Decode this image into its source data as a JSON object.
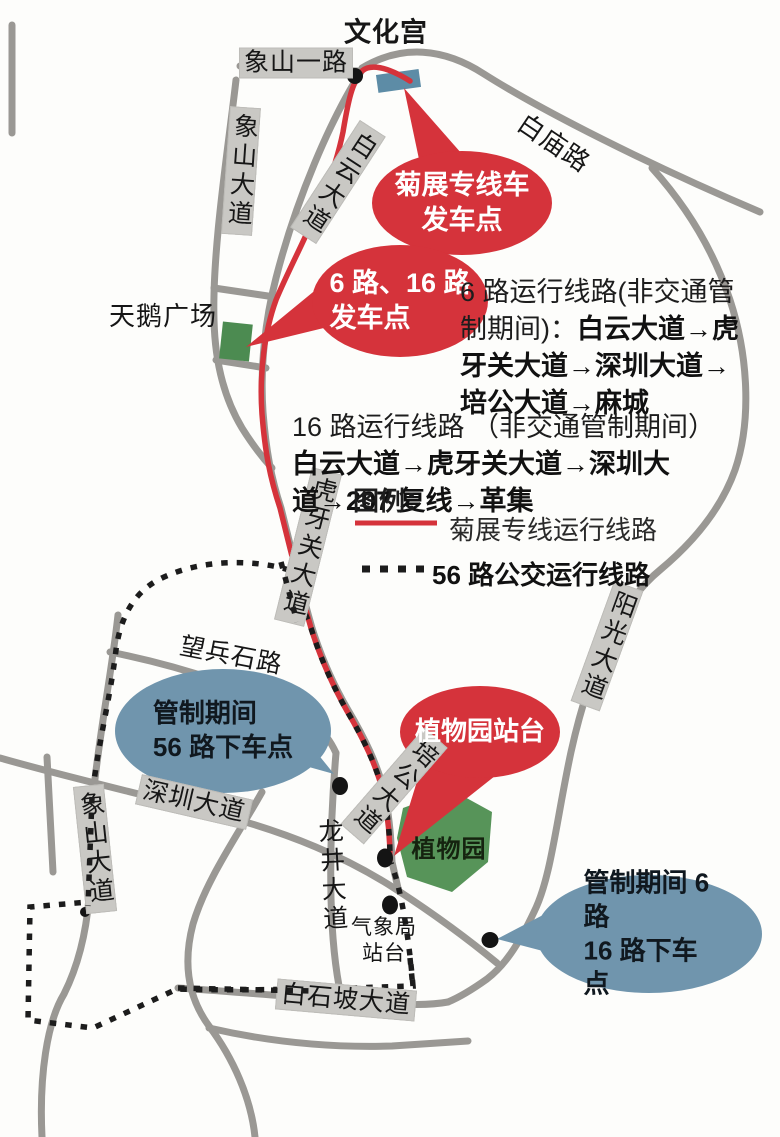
{
  "map": {
    "places": {
      "wenhuagong": "文化宫",
      "tiane_guangchang": "天鹅广场",
      "zhiwuyuan": "植物园",
      "qixiangju_zhantai": "气象局\n站台"
    },
    "roads": {
      "xiangshan_yilu": "象山一路",
      "xiangshan_dadao_top": "象山大道",
      "baiyun_dadao": "白云大道",
      "baimiao_lu": "白庙路",
      "huyaguan_dadao": "虎牙关大道",
      "wangbingshi_lu": "望兵石路",
      "yangguang_dadao": "阳光大道",
      "peigong_dadao": "培公大道",
      "shenzhen_dadao": "深圳大道",
      "xiangshan_dadao_bottom": "象山大道",
      "longjing_dadao": "龙井大道",
      "baishipo_dadao": "白石坡大道"
    },
    "callouts": {
      "departure_special": "菊展专线车\n发车点",
      "departure_6_16": "6 路、16 路\n发车点",
      "zhiwuyuan_stop": "植物园站台",
      "dropoff_56": "管制期间\n56 路下车点",
      "dropoff_6_16": "管制期间 6 路\n16 路下车点"
    },
    "notes": {
      "route6_normal": "6 路运行线路(非交通管\n制期间)：",
      "route6_bold": "白云大道→虎\n牙关大道→深圳大道→\n培公大道→麻城",
      "route16_normal": "16 路运行线路 （非交通管制期间）",
      "route16_bold": "\n白云大道→虎牙关大道→深圳大\n道→207 复线→革集"
    },
    "legend": {
      "title": "图例：",
      "special_line_label": "菊展专线运行线路",
      "bus56_line_label": "56 路公交运行线路"
    },
    "colors": {
      "route_red": "#d5333b",
      "balloon_blue": "#7095ad",
      "road_gray": "#9a9894",
      "label_gray": "#c9c8c4",
      "park_green": "#4c8b51",
      "stop_rect_blue": "#5d8ca6",
      "dotted_black": "#1c1c1c"
    }
  }
}
